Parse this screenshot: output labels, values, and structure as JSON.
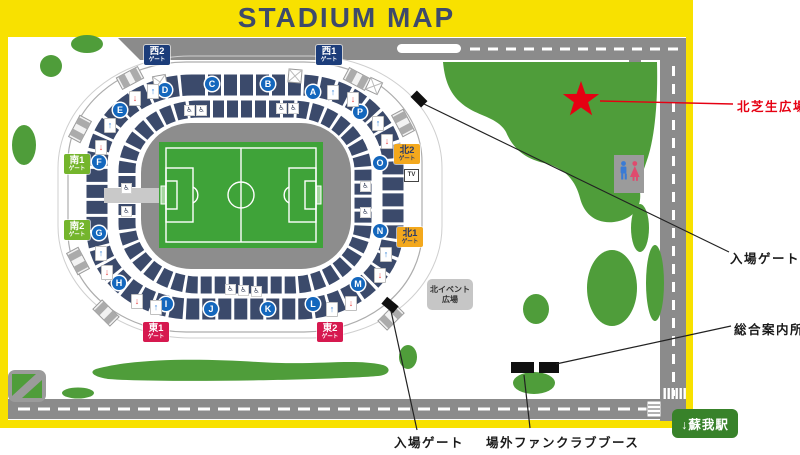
{
  "header": {
    "title": "STADIUM MAP"
  },
  "stadium": {
    "gates": [
      {
        "id": "west2",
        "name": "西2",
        "suffix": "ゲート",
        "bg": "#1c3d7a",
        "fg": "#ffffff"
      },
      {
        "id": "west1",
        "name": "西1",
        "suffix": "ゲート",
        "bg": "#1c3d7a",
        "fg": "#ffffff"
      },
      {
        "id": "south1",
        "name": "南1",
        "suffix": "ゲート",
        "bg": "#74b52c",
        "fg": "#ffffff"
      },
      {
        "id": "south2",
        "name": "南2",
        "suffix": "ゲート",
        "bg": "#74b52c",
        "fg": "#ffffff"
      },
      {
        "id": "east1",
        "name": "東1",
        "suffix": "ゲート",
        "bg": "#d6194f",
        "fg": "#ffffff"
      },
      {
        "id": "east2",
        "name": "東2",
        "suffix": "ゲート",
        "bg": "#d6194f",
        "fg": "#ffffff"
      },
      {
        "id": "north2",
        "name": "北2",
        "suffix": "ゲート",
        "bg": "#f3a81d",
        "fg": "#2c3c68"
      },
      {
        "id": "north1",
        "name": "北1",
        "suffix": "ゲート",
        "bg": "#f3a81d",
        "fg": "#2c3c68"
      }
    ],
    "sections": [
      "A",
      "B",
      "C",
      "D",
      "E",
      "F",
      "G",
      "H",
      "I",
      "J",
      "K",
      "L",
      "M",
      "N",
      "O",
      "P"
    ],
    "tv_label": "TV",
    "north_event_plaza": {
      "line1": "北イベント",
      "line2": "広場"
    }
  },
  "annotations": {
    "north_lawn_plaza": "北芝生広場",
    "entrance_gate_ne": "入場ゲート",
    "info_center": "総合案内所",
    "entrance_gate_se": "入場ゲート",
    "fanclub_booth": "場外ファンクラブブース",
    "station": "↓蘇我駅"
  },
  "icons": {
    "arrow_up": "↑",
    "arrow_down": "↓",
    "wheelchair": "♿"
  },
  "colors": {
    "brand-yellow": "#f8e100",
    "title-navy": "#3e4a6b",
    "road-gray": "#8b8b8b",
    "lawn-green": "#4f9d3a",
    "pitch-green": "#3fa339",
    "seat-navy": "#3b4a6b",
    "badge-blue": "#1467bd",
    "star-red": "#e60012",
    "station-green": "#38822a"
  }
}
